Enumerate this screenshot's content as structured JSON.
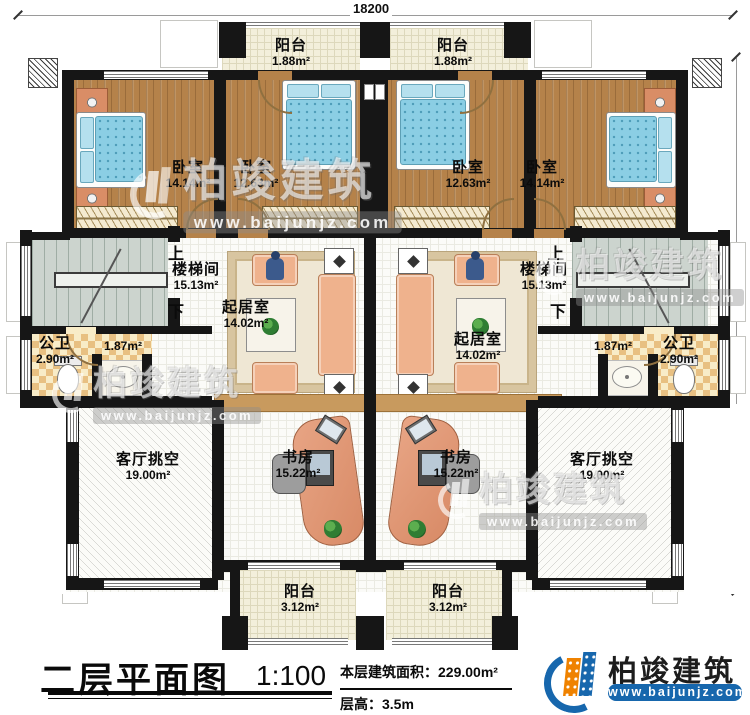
{
  "dimensions": {
    "top": "18200",
    "right": "15840"
  },
  "stair": {
    "up": "上",
    "down": "下"
  },
  "rooms": {
    "balcony_top_left": {
      "name": "阳台",
      "area": "1.88m²"
    },
    "balcony_top_right": {
      "name": "阳台",
      "area": "1.88m²"
    },
    "bedroom_far_left": {
      "name": "卧室",
      "area": "14.14m²"
    },
    "bedroom_mid_left": {
      "name": "卧室",
      "area": "12.63m²"
    },
    "bedroom_mid_right": {
      "name": "卧室",
      "area": "12.63m²"
    },
    "bedroom_far_right": {
      "name": "卧室",
      "area": "14.14m²"
    },
    "stair_left": {
      "name": "楼梯间",
      "area": "15.13m²"
    },
    "stair_right": {
      "name": "楼梯间",
      "area": "15.13m²"
    },
    "bath_left": {
      "name": "公卫",
      "area": "2.90m²",
      "basin_area": "1.87m²"
    },
    "bath_right": {
      "name": "公卫",
      "area": "2.90m²",
      "basin_area": "1.87m²"
    },
    "living_left": {
      "name": "起居室",
      "area": "14.02m²"
    },
    "living_right": {
      "name": "起居室",
      "area": "14.02m²"
    },
    "void_left": {
      "name": "客厅挑空",
      "area": "19.00m²"
    },
    "void_right": {
      "name": "客厅挑空",
      "area": "19.00m²"
    },
    "study_left": {
      "name": "书房",
      "area": "15.22m²"
    },
    "study_right": {
      "name": "书房",
      "area": "15.22m²"
    },
    "balcony_bottom_left": {
      "name": "阳台",
      "area": "3.12m²"
    },
    "balcony_bottom_right": {
      "name": "阳台",
      "area": "3.12m²"
    }
  },
  "title_block": {
    "title": "二层平面图",
    "scale": "1:100",
    "area_label": "本层建筑面积：",
    "area_value": "229.00m²",
    "floor_height_label": "层高：",
    "floor_height_value": "3.5m"
  },
  "brand": {
    "name": "柏竣建筑",
    "website": "www.baijunjz.com"
  },
  "watermark": {
    "name": "柏竣建筑",
    "website": "www.baijunjz.com"
  },
  "colors": {
    "brand_blue": "#1767ad",
    "brand_orange": "#ef8200",
    "wall": "#161616"
  }
}
